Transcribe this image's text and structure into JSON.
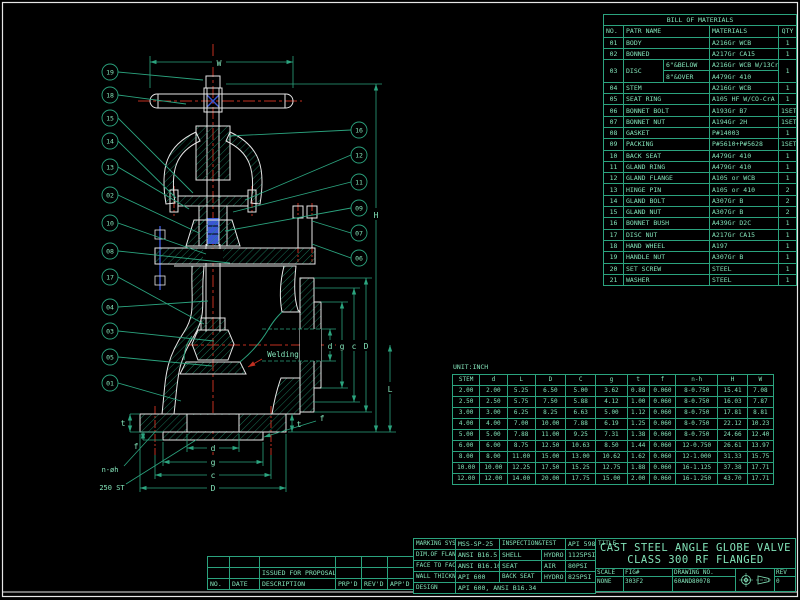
{
  "colors": {
    "green_line": "#2ba37e",
    "green_text": "#82e2b8",
    "white": "#e6e6e6",
    "red": "#c22f21",
    "blue": "#3a56d4",
    "background": "#000000"
  },
  "bom": {
    "title": "BILL OF MATERIALS",
    "headers": {
      "no": "NO.",
      "name": "PATR NAME",
      "material": "MATERIALS",
      "qty": "QTY"
    },
    "rows_top": [
      {
        "no": "01",
        "name": "BODY",
        "material": "A216Gr WCB",
        "qty": "1"
      },
      {
        "no": "02",
        "name": "BONNED",
        "material": "A217Gr CA15",
        "qty": "1"
      }
    ],
    "disc": {
      "no": "03",
      "name": "DISC",
      "sub1_name": "6\"&BELOW",
      "sub1_material": "A216Gr WCB W/13Cr",
      "sub2_name": "8\"&OVER",
      "sub2_material": "A479Gr 410",
      "qty": "1"
    },
    "rows_rest": [
      {
        "no": "04",
        "name": "STEM",
        "material": "A216Gr WCB",
        "qty": "1"
      },
      {
        "no": "05",
        "name": "SEAT RING",
        "material": "A105 HF W/CO-CrA",
        "qty": "1"
      },
      {
        "no": "06",
        "name": "BONNET BOLT",
        "material": "A193Gr B7",
        "qty": "1SET"
      },
      {
        "no": "07",
        "name": "BONNET NUT",
        "material": "A194Gr 2H",
        "qty": "1SET"
      },
      {
        "no": "08",
        "name": "GASKET",
        "material": "P#14003",
        "qty": "1"
      },
      {
        "no": "09",
        "name": "PACKING",
        "material": "P#5610+P#5628",
        "qty": "1SET"
      },
      {
        "no": "10",
        "name": "BACK SEAT",
        "material": "A479Gr 410",
        "qty": "1"
      },
      {
        "no": "11",
        "name": "GLAND RING",
        "material": "A479Gr 410",
        "qty": "1"
      },
      {
        "no": "12",
        "name": "GLAND FLANGE",
        "material": "A105 or WCB",
        "qty": "1"
      },
      {
        "no": "13",
        "name": "HINGE PIN",
        "material": "A105 or 410",
        "qty": "2"
      },
      {
        "no": "14",
        "name": "GLAND BOLT",
        "material": "A307Gr B",
        "qty": "2"
      },
      {
        "no": "15",
        "name": "GLAND NUT",
        "material": "A307Gr B",
        "qty": "2"
      },
      {
        "no": "16",
        "name": "BONNET BUSH",
        "material": "A439Gr D2C",
        "qty": "1"
      },
      {
        "no": "17",
        "name": "DISC NUT",
        "material": "A217Gr CA15",
        "qty": "1"
      },
      {
        "no": "18",
        "name": "HAND WHEEL",
        "material": "A197",
        "qty": "1"
      },
      {
        "no": "19",
        "name": "HANDLE NUT",
        "material": "A307Gr B",
        "qty": "1"
      },
      {
        "no": "20",
        "name": "SET SCREW",
        "material": "STEEL",
        "qty": "1"
      },
      {
        "no": "21",
        "name": "WASHER",
        "material": "STEEL",
        "qty": "1"
      }
    ]
  },
  "dim_table": {
    "unit": "UNIT:INCH",
    "headers": [
      "STEM",
      "d",
      "L",
      "D",
      "C",
      "g",
      "t",
      "f",
      "n-h",
      "H",
      "W"
    ],
    "rows": [
      [
        "2.00",
        "2.00",
        "5.25",
        "6.50",
        "5.00",
        "3.62",
        "0.88",
        "0.060",
        "8-0.750",
        "15.41",
        "7.08"
      ],
      [
        "2.50",
        "2.50",
        "5.75",
        "7.50",
        "5.88",
        "4.12",
        "1.00",
        "0.060",
        "8-0.750",
        "16.03",
        "7.87"
      ],
      [
        "3.00",
        "3.00",
        "6.25",
        "8.25",
        "6.63",
        "5.00",
        "1.12",
        "0.060",
        "8-0.750",
        "17.81",
        "8.81"
      ],
      [
        "4.00",
        "4.00",
        "7.00",
        "10.00",
        "7.88",
        "6.19",
        "1.25",
        "0.060",
        "8-0.750",
        "22.12",
        "10.23"
      ],
      [
        "5.00",
        "5.00",
        "7.88",
        "11.00",
        "9.25",
        "7.31",
        "1.38",
        "0.060",
        "8-0.750",
        "24.66",
        "12.40"
      ],
      [
        "6.00",
        "6.00",
        "8.75",
        "12.50",
        "10.63",
        "8.50",
        "1.44",
        "0.060",
        "12-0.750",
        "26.61",
        "13.97"
      ],
      [
        "8.00",
        "8.00",
        "11.00",
        "15.00",
        "13.00",
        "10.62",
        "1.62",
        "0.060",
        "12-1.000",
        "31.33",
        "15.75"
      ],
      [
        "10.00",
        "10.00",
        "12.25",
        "17.50",
        "15.25",
        "12.75",
        "1.88",
        "0.060",
        "16-1.125",
        "37.38",
        "17.71"
      ],
      [
        "12.00",
        "12.00",
        "14.00",
        "20.00",
        "17.75",
        "15.00",
        "2.00",
        "0.060",
        "16-1.250",
        "43.70",
        "17.71"
      ]
    ]
  },
  "title_block": {
    "spec": {
      "marking_label": "MARKING SYSTEM",
      "marking_value": "MSS-SP-25",
      "inspection_label": "INSPECTION&TEST",
      "inspection_value": "API 598",
      "dim_flange_label": "DIM.OF FLANGE",
      "dim_flange_value": "ANSI B16.5",
      "shell_label": "SHELL",
      "shell_medium": "HYDRO",
      "shell_value": "1125PSI",
      "f2f_label": "FACE TO FACE",
      "f2f_value": "ANSI B16.10",
      "seat_label": "SEAT",
      "seat_medium": "AIR",
      "seat_value": "80PSI",
      "wall_label": "WALL THICKNESS",
      "wall_value": "API 600",
      "backseat_label": "BACK SEAT",
      "backseat_medium": "HYDRO",
      "backseat_value": "825PSI",
      "design_label": "DESIGN",
      "design_value": "API 600, ANSI B16.34"
    },
    "title_label": "TITLE",
    "title_line1": "CAST STEEL ANGLE GLOBE VALVE",
    "title_line2": "CLASS 300 RF FLANGED",
    "scale_label": "SCALE",
    "scale_value": "NONE",
    "fig_label": "FIG#",
    "fig_value": "303F2",
    "dwg_label": "DRAWING NO.",
    "dwg_value": "60AND80078",
    "rev_label": "REV",
    "rev_value": "0"
  },
  "revision_table": {
    "headers": {
      "no": "NO.",
      "date": "DATE",
      "description": "DESCRIPTION",
      "prpd": "PRP'D",
      "revd": "REV'D",
      "appd": "APP'D"
    },
    "proposal_row": "ISSUED FOR PROPOSAL"
  },
  "drawing": {
    "balloons_left": [
      "19",
      "18",
      "15",
      "14",
      "13",
      "02",
      "10",
      "08",
      "17",
      "04",
      "03",
      "05",
      "01"
    ],
    "balloons_right": [
      "16",
      "12",
      "11",
      "09",
      "07",
      "06"
    ],
    "labels": {
      "w": "W",
      "h": "H",
      "l": "L",
      "d": "d",
      "g": "g",
      "c": "c",
      "dd": "D",
      "t": "t",
      "f": "f",
      "n_h": "n-øh",
      "st": "250 ST",
      "welding": "Welding"
    }
  }
}
